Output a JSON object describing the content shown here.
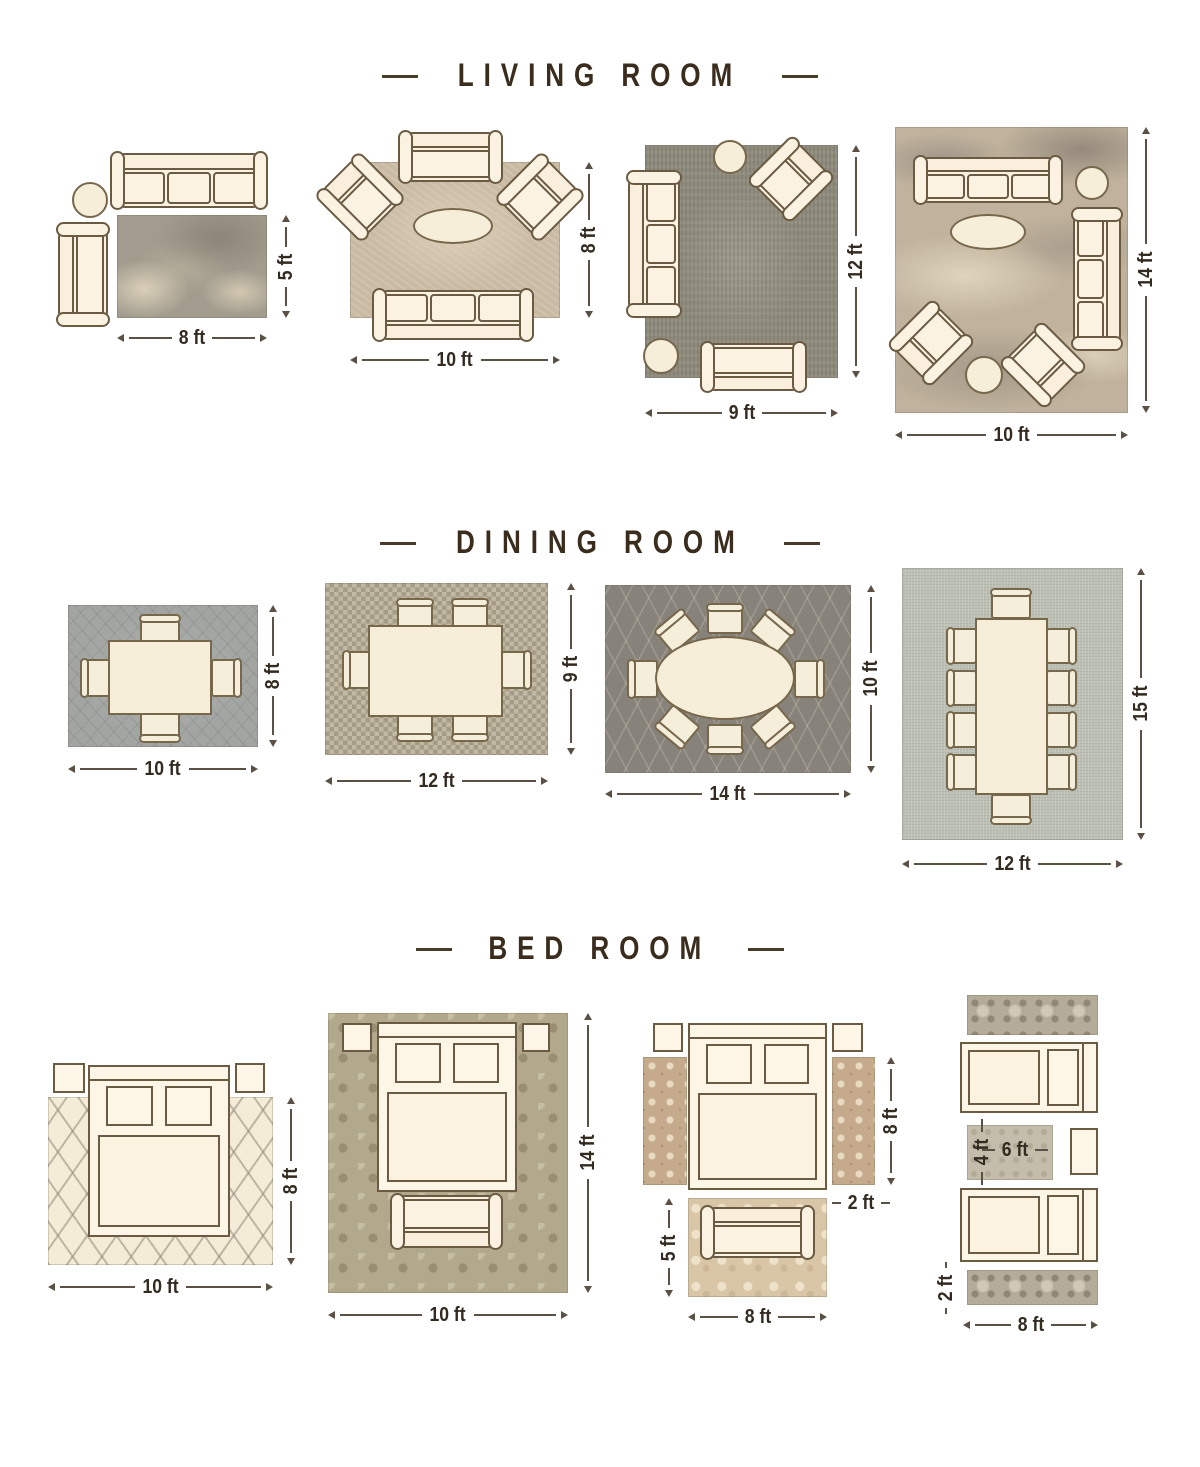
{
  "titles": {
    "living": "LIVING ROOM",
    "dining": "DINING ROOM",
    "bed": "BED ROOM"
  },
  "living": {
    "l1": {
      "w": "8 ft",
      "h": "5 ft"
    },
    "l2": {
      "w": "10 ft",
      "h": "8 ft"
    },
    "l3": {
      "w": "9 ft",
      "h": "12 ft"
    },
    "l4": {
      "w": "10 ft",
      "h": "14 ft"
    }
  },
  "dining": {
    "d1": {
      "w": "10 ft",
      "h": "8 ft"
    },
    "d2": {
      "w": "12 ft",
      "h": "9 ft"
    },
    "d3": {
      "w": "14 ft",
      "h": "10 ft"
    },
    "d4": {
      "w": "12 ft",
      "h": "15 ft"
    }
  },
  "bed": {
    "b1": {
      "w": "10 ft",
      "h": "8 ft"
    },
    "b2": {
      "w": "10 ft",
      "h": "14 ft"
    },
    "b3": {
      "side": "8 ft",
      "runner_w": "2 ft",
      "foot_h": "5 ft",
      "foot_w": "8 ft"
    },
    "b4": {
      "rug_h": "4 ft",
      "rug_w": "6 ft",
      "runner_w": "2 ft",
      "w": "8 ft"
    }
  },
  "colors": {
    "text": "#3a2e20",
    "dimension_line": "#5b5044",
    "furniture_fill": "#fbf2e2",
    "furniture_outline": "#6a5b42"
  }
}
